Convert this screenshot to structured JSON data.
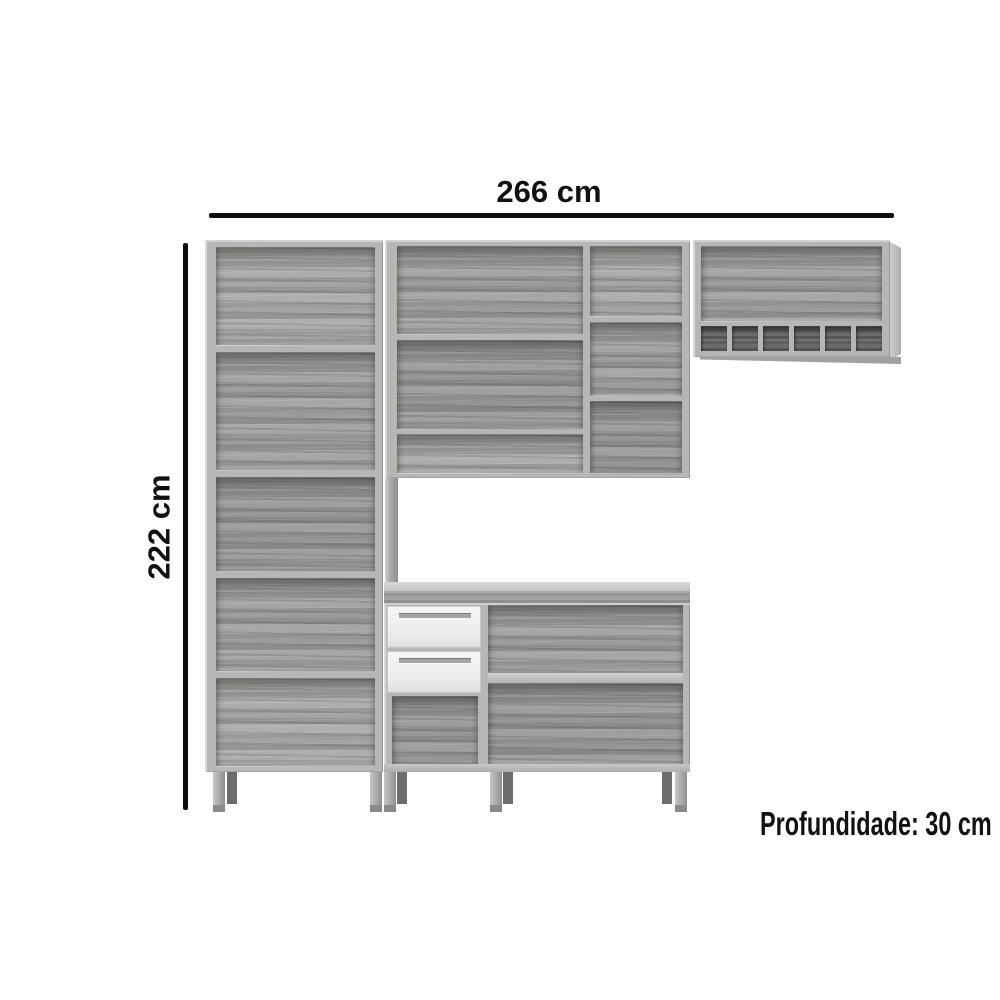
{
  "dimensions": {
    "width_label": "266 cm",
    "height_label": "222 cm",
    "depth_label": "Profundidade: 30 cm"
  },
  "colors": {
    "background": "#ffffff",
    "dimension_line": "#0d0d0d",
    "dimension_text": "#111111",
    "frame_mid": "#b6b6b4",
    "wood_light": "#a4a4a2",
    "wood_mid": "#9b9b99",
    "wood_dark": "#8d8d8b",
    "rack_interior": "#616160",
    "drawer_face": "#ececea",
    "drawer_handle": "#a5a5a3",
    "leg_front": "#a9a9a7",
    "leg_back": "#6d6d6b"
  }
}
